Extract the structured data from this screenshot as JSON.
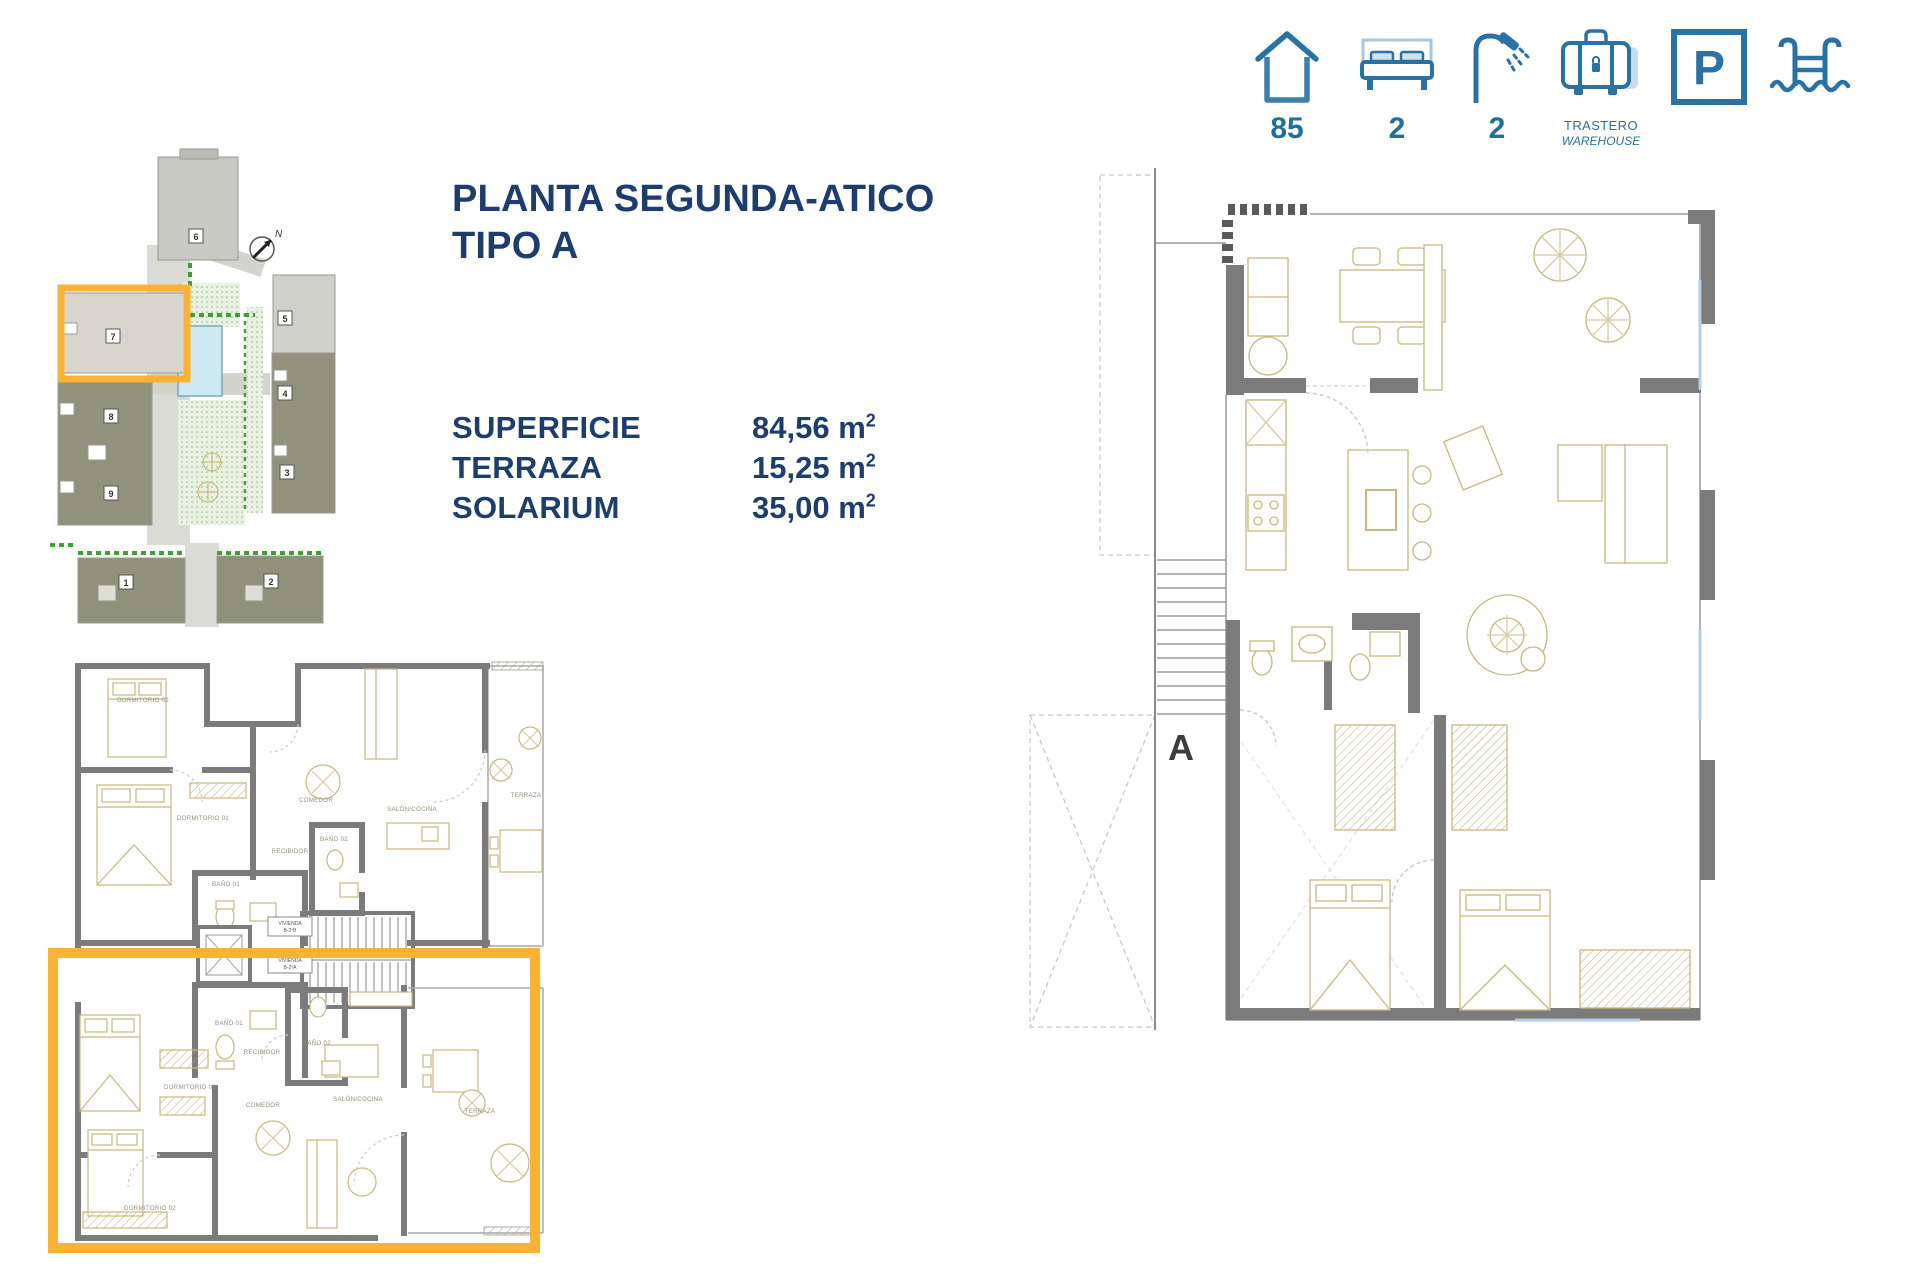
{
  "colors": {
    "accent_blue": "#2A72A4",
    "light_blue": "#A9C6DB",
    "navy_text": "#1C3D6E",
    "highlight_yellow": "#F9B233",
    "wall_gray": "#7B7B7B"
  },
  "amenities": {
    "area_value": "85",
    "bedrooms_value": "2",
    "bathrooms_value": "2",
    "storage_label": "TRASTERO",
    "storage_sublabel": "WAREHOUSE",
    "parking_letter": "P"
  },
  "header": {
    "title_line1": "PLANTA SEGUNDA-ATICO",
    "title_line2": "TIPO A"
  },
  "specs": {
    "rows": [
      {
        "label": "SUPERFICIE",
        "value": "84,56 m",
        "sup": "2"
      },
      {
        "label": "TERRAZA",
        "value": "15,25 m",
        "sup": "2"
      },
      {
        "label": "SOLARIUM",
        "value": "35,00 m",
        "sup": "2"
      }
    ]
  },
  "site_plan": {
    "north": "N",
    "blocks": {
      "b1": "1",
      "b2": "2",
      "b3": "3",
      "b4": "4",
      "b5": "5",
      "b6": "6",
      "b7": "7",
      "b8": "8",
      "b9": "9"
    },
    "highlighted_block": "7"
  },
  "small_plan": {
    "upper": {
      "dorm02": "DORMITORIO 02",
      "dorm01": "DORMITORIO 01",
      "bano01": "BAÑO 01",
      "bano02": "BAÑO 02",
      "recibidor": "RECIBIDOR",
      "comedor": "COMEDOR",
      "salon": "SALÓN/COCINA",
      "terraza": "TERRAZA"
    },
    "lower": {
      "dorm02": "DORMITORIO 02",
      "dorm01": "DORMITORIO 01",
      "bano01": "BAÑO 01",
      "bano02": "BAÑO 02",
      "recibidor": "RECIBIDOR",
      "comedor": "COMEDOR",
      "salon": "SALÓN/COCINA",
      "terraza": "TERRAZA"
    },
    "core": {
      "vivienda": "VIVIENDA",
      "unit_b": "B-2ºB",
      "unit_a": "B-2ºA"
    }
  },
  "large_plan": {
    "section_label": "A"
  }
}
